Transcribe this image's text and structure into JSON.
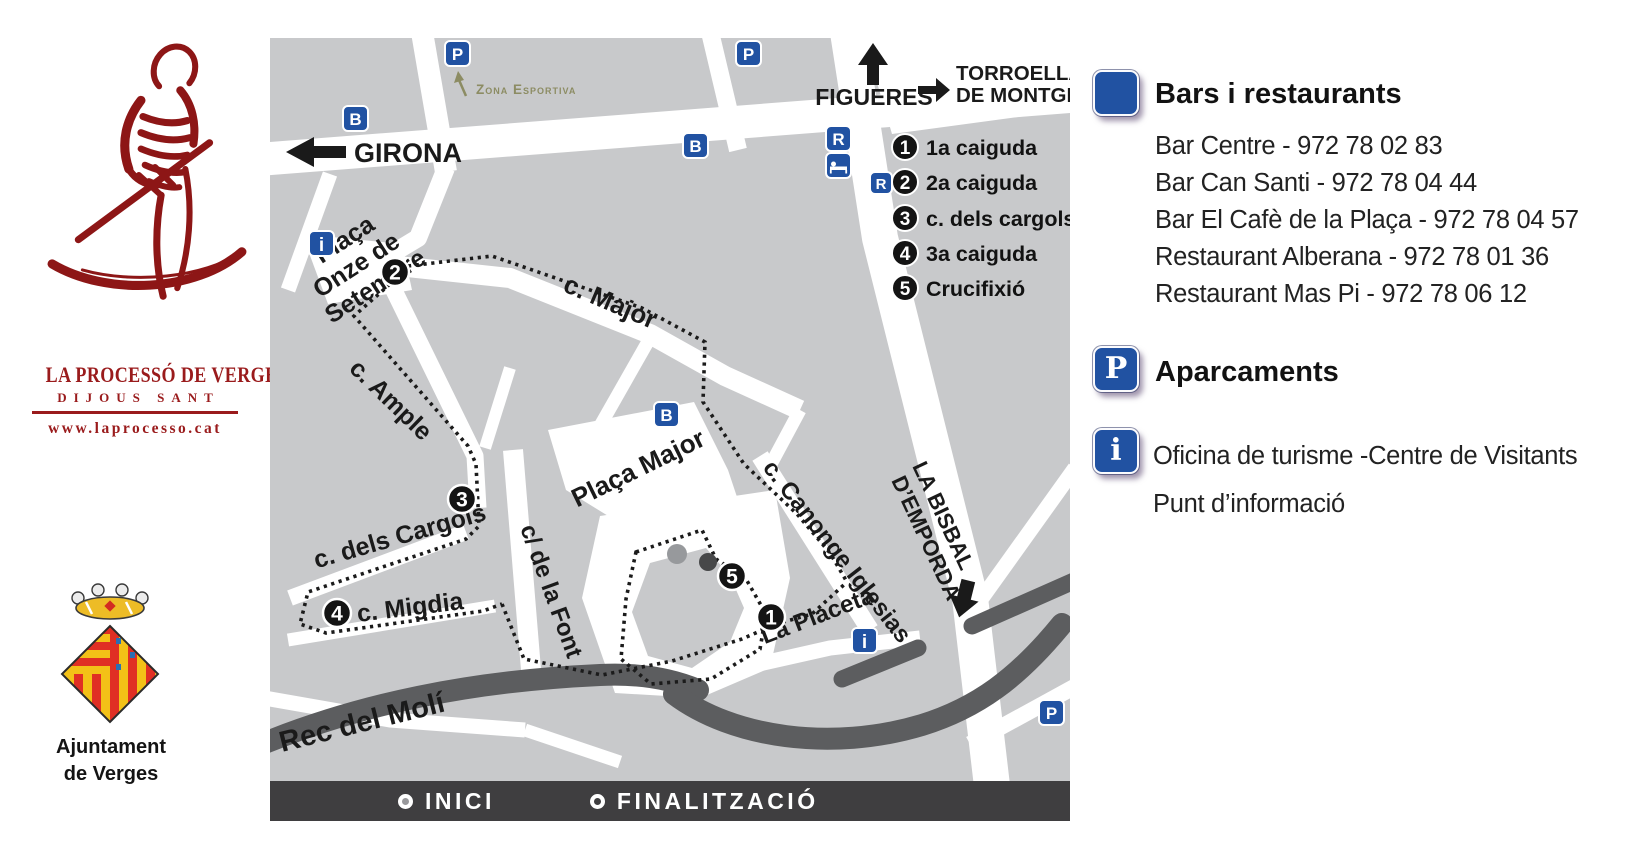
{
  "branding": {
    "title": "LA PROCESSÓ DE VERGES",
    "subtitle": "DIJOUS SANT",
    "website": "www.laprocesso.cat",
    "org_line1": "Ajuntament",
    "org_line2": "de Verges"
  },
  "map": {
    "directions": {
      "girona": "GIRONA",
      "figueres": "FIGUERES",
      "torroella1": "TORROELLA",
      "torroella2": "DE MONTGRÍ",
      "bisbal1": "LA BISBAL",
      "bisbal2": "D’EMPORDÀ"
    },
    "poi": {
      "zona_esportiva": "Zona Esportiva"
    },
    "streets": {
      "onze1": "Plaça",
      "onze2": "Onze de",
      "onze3": "Setembre",
      "major": "c. Major",
      "ample": "c. Ample",
      "placa_major": "Plaça Major",
      "cargols": "c. dels Cargols",
      "migdia": "c. Migdia",
      "font": "c/ de la Font",
      "canonge": "c. Canonge Iglesias",
      "placeta": "La Placeta",
      "rec": "Rec del Molí"
    },
    "route_legend": [
      {
        "number": "1",
        "label": "1a caiguda"
      },
      {
        "number": "2",
        "label": "2a caiguda"
      },
      {
        "number": "3",
        "label": "c. dels cargols"
      },
      {
        "number": "4",
        "label": "3a caiguda"
      },
      {
        "number": "5",
        "label": "Crucifixió"
      }
    ],
    "markers": {
      "m1": "1",
      "m2": "2",
      "m3": "3",
      "m4": "4",
      "m5": "5"
    },
    "icon_letters": {
      "parking": "P",
      "bar": "B",
      "restaurant": "R",
      "info": "i"
    },
    "footer": {
      "start": "INICI",
      "end": "FINALITZACIÓ"
    }
  },
  "sidebar": {
    "bars": {
      "title": "Bars i restaurants",
      "items": [
        "Bar Centre - 972 78 02 83",
        "Bar Can Santi - 972 78 04 44",
        "Bar El Cafè de la Plaça - 972 78 04 57",
        "Restaurant Alberana - 972 78 01 36",
        "Restaurant Mas Pi - 972 78 06 12"
      ]
    },
    "parking": {
      "icon": "P",
      "title": "Aparcaments"
    },
    "info": {
      "icon": "i",
      "line1": "Oficina de turisme -Centre de Visitants",
      "line2": "Punt d’informació"
    }
  },
  "colors": {
    "brand_red": "#9a1b1c",
    "icon_blue": "#2152a2",
    "map_gray": "#c8c9cb",
    "river_gray": "#5c5d5f",
    "footer_gray": "#3f3e40",
    "zona_olive": "#8c8c63"
  }
}
